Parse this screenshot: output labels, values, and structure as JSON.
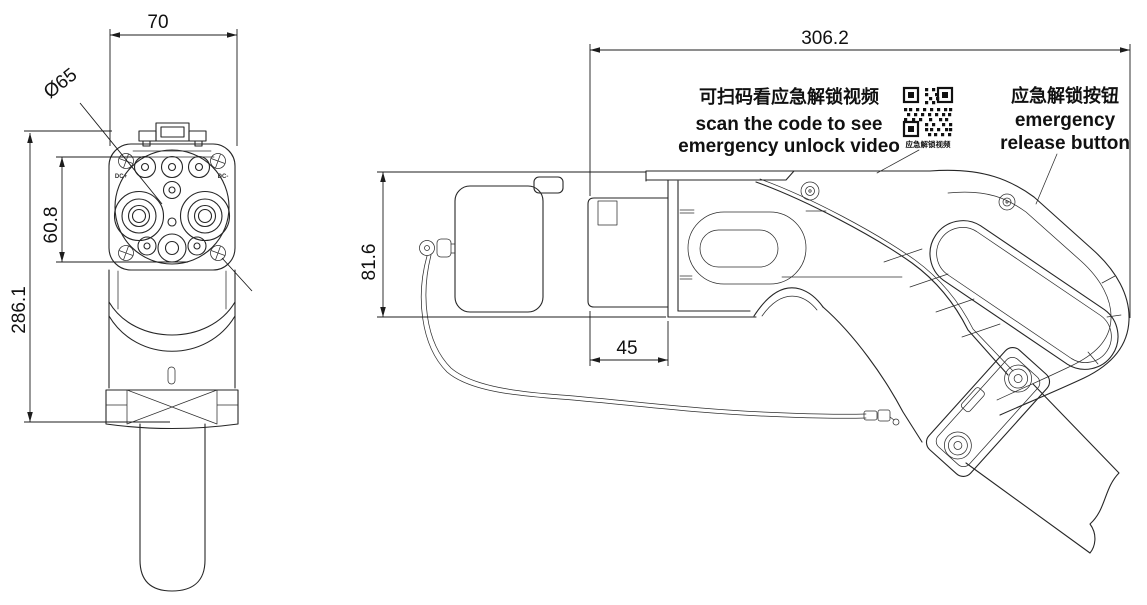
{
  "front_view": {
    "dim_width": "70",
    "dim_diameter": "Ø65",
    "dim_pin_field": "60.8",
    "dim_overall_height": "286.1",
    "label_dc_plus": "DC+",
    "label_dc_minus": "DC-"
  },
  "side_view": {
    "dim_overall_length": "306.2",
    "dim_nozzle": "45",
    "dim_height": "81.6"
  },
  "annotations": {
    "scan_zh": "可扫码看应急解锁视频",
    "scan_en1": "scan the code to see",
    "scan_en2": "emergency unlock video",
    "qr_caption": "应急解锁视频",
    "release_zh": "应急解锁按钮",
    "release_en1": "emergency",
    "release_en2": "release button"
  }
}
